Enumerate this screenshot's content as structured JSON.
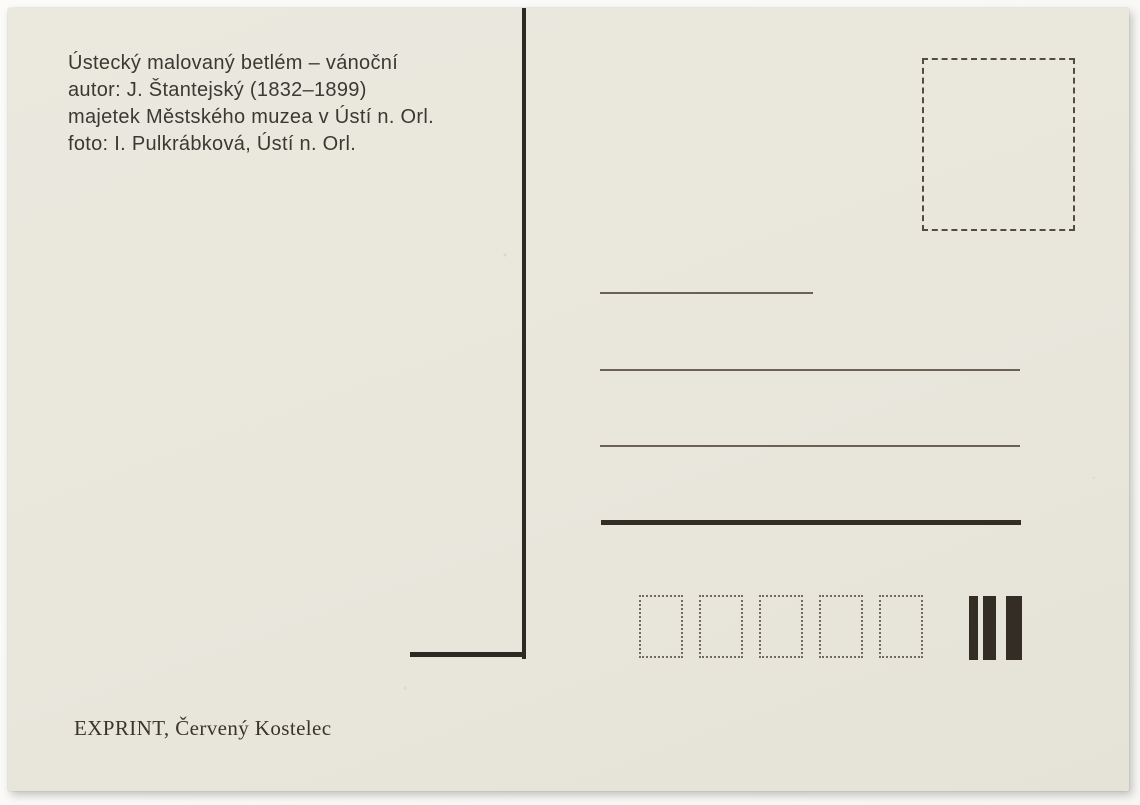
{
  "postcard": {
    "credits": {
      "lines": [
        "Ústecký malovaný betlém – vánoční",
        "autor: J. Štantejský (1832–1899)",
        "majetek Městského muzea v Ústí n. Orl.",
        "foto: I. Pulkrábková, Ústí n. Orl."
      ]
    },
    "imprint": "EXPRINT, Červený Kostelec",
    "postal_code_box_count": 5,
    "sorting_bar_count": 3,
    "colors": {
      "card_background": "#e9e7dc",
      "photo_background": "#f9f9f7",
      "ink": "#2d2923",
      "caption_text": "#3c3833",
      "thin_line": "#6b6255",
      "thick_line": "#332d26",
      "dash_border": "#544c41",
      "dot_border": "#746a5c"
    }
  }
}
